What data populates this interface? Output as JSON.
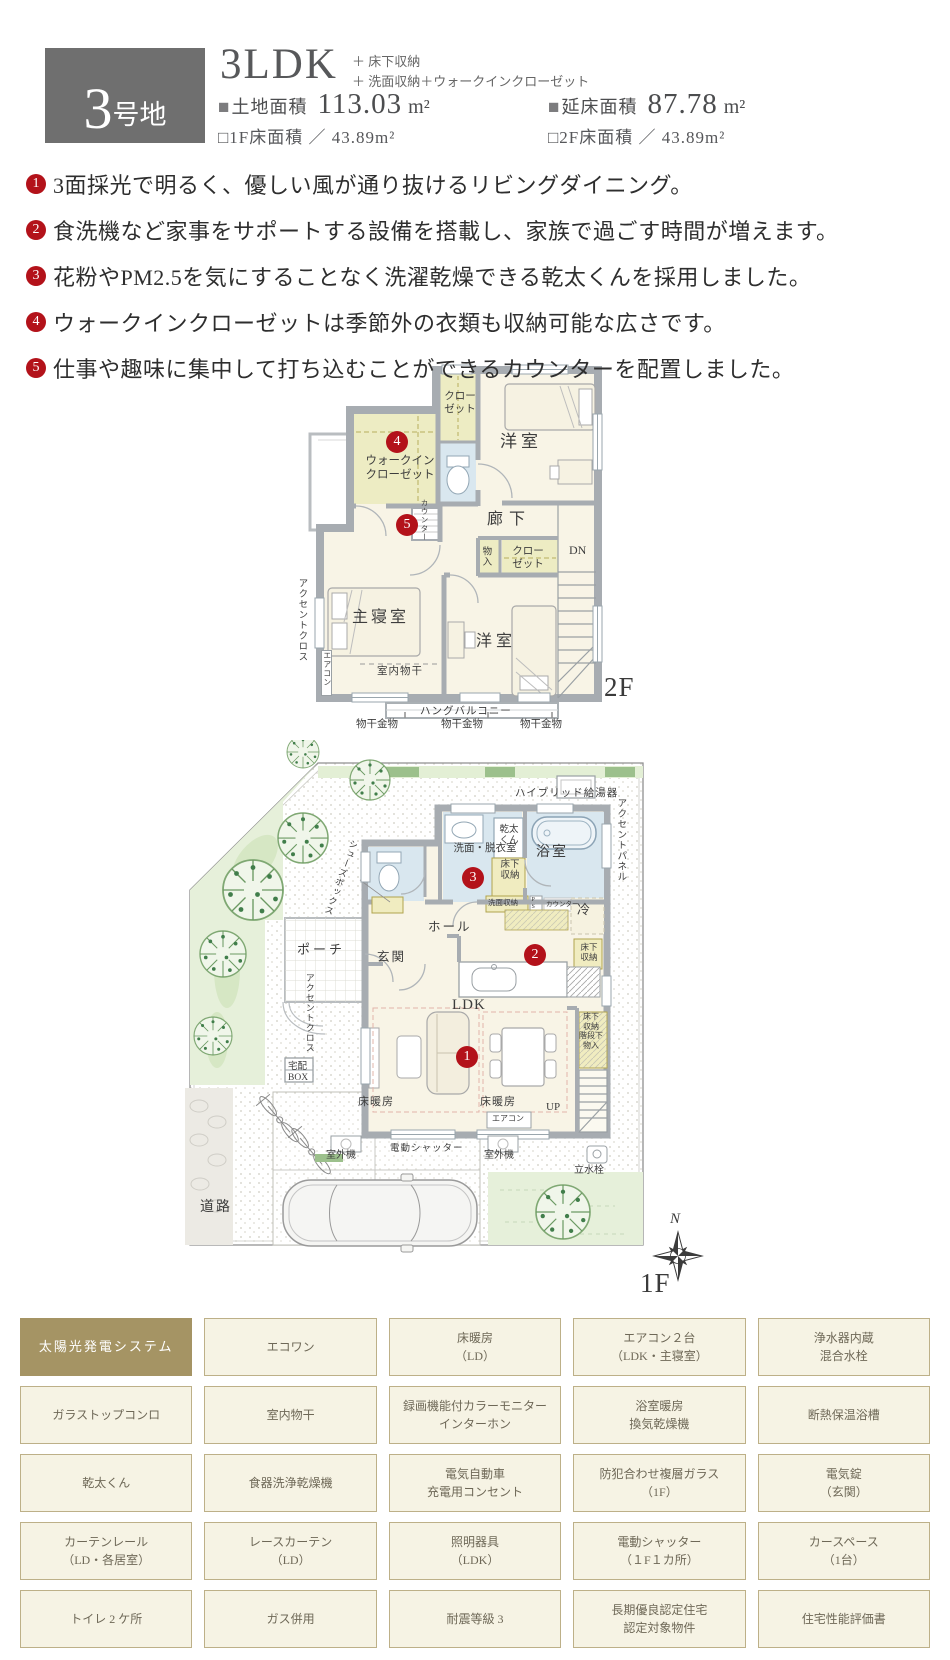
{
  "colors": {
    "accent_red": "#b3121a",
    "badge_gray": "#6f6f6f",
    "grid_highlight_bg": "#a59464",
    "grid_cell_bg": "#f6f3e4",
    "grid_border": "#bdb088",
    "room_cream": "#f8f4e6",
    "closet_yellow": "#edecc3",
    "wet_area_blue": "#d9e7ef",
    "garden_green": "#e6f0da",
    "wall_gray": "#a7acb1"
  },
  "header": {
    "lot_badge_num": "3",
    "lot_badge_suffix": "号地",
    "plan_type": "3LDK",
    "plan_extra": "＋ 床下収納\n＋ 洗面収納＋ウォークインクローゼット",
    "land_bullet": "■",
    "land_label": "土地面積",
    "land_value": "113.03",
    "land_unit": "m²",
    "total_bullet": "■",
    "total_label": "延床面積",
    "total_value": "87.78",
    "total_unit": "m²",
    "floor1_area": "□1F床面積 ／ 43.89m²",
    "floor2_area": "□2F床面積 ／ 43.89m²"
  },
  "notes": [
    {
      "num": "1",
      "text": "3面採光で明るく、優しい風が通り抜けるリビングダイニング。"
    },
    {
      "num": "2",
      "text": "食洗機など家事をサポートする設備を搭載し、家族で過ごす時間が増えます。"
    },
    {
      "num": "3",
      "text": "花粉やPM2.5を気にすることなく洗濯乾燥できる乾太くんを採用しました。"
    },
    {
      "num": "4",
      "text": "ウォークインクローゼットは季節外の衣類も収納可能な広さです。"
    },
    {
      "num": "5",
      "text": "仕事や趣味に集中して打ち込むことができるカウンターを配置しました。"
    }
  ],
  "plan2f": {
    "floor_tag": "2F",
    "markers": {
      "wic": "4",
      "counter": "5"
    },
    "labels": {
      "closet_top": "クロー\nゼット",
      "bedroom_top": "洋室",
      "wic": "ウォークイン\nクローゼット",
      "counter": "カウンター",
      "hallway": "廊下",
      "storage": "物入",
      "closet_mid": "クロー\nゼット",
      "down": "DN",
      "accent_cloth": "アクセントクロス",
      "aircon": "エアコン",
      "master_bedroom": "主寝室",
      "indoor_drying": "室内物干",
      "bedroom_bottom": "洋室",
      "hang_balcony": "ハングバルコニー",
      "drying_hardware": "物干金物"
    }
  },
  "plan1f": {
    "floor_tag": "1F",
    "north": "N",
    "markers": {
      "living": "1",
      "kitchen": "2",
      "laundry": "3"
    },
    "labels": {
      "road": "道路",
      "hybrid_heater": "ハイブリッド給湯器",
      "accent_panel": "アクセントパネル",
      "shoes_box": "シューズボックス",
      "kanta_kun": "乾太\nくん",
      "washroom": "洗面・脱衣室",
      "floor_storage1": "床下\n収納",
      "bathroom": "浴室",
      "wash_storage": "洗面収納",
      "ps": "PS",
      "counter": "カウンター",
      "fridge": "冷",
      "floor_storage2": "床下\n収納",
      "porch": "ポーチ",
      "entrance": "玄関",
      "hall": "ホール",
      "accent_cloth": "アクセントクロス",
      "delivery_box": "宅配\nBOX",
      "ldk": "LDK",
      "under_stairs": "床下\n収納\n階段下\n物入",
      "floor_heating": "床暖房",
      "aircon": "エアコン",
      "up": "UP",
      "shutter": "電動シャッター",
      "outdoor_unit": "室外機",
      "faucet": "立水栓"
    }
  },
  "equipment_grid": {
    "rows": [
      [
        "太陽光発電システム",
        "エコワン",
        "床暖房\n（LD）",
        "エアコン２台\n（LDK・主寝室）",
        "浄水器内蔵\n混合水栓"
      ],
      [
        "ガラストップコンロ",
        "室内物干",
        "録画機能付カラーモニター\nインターホン",
        "浴室暖房\n換気乾燥機",
        "断熱保温浴槽"
      ],
      [
        "乾太くん",
        "食器洗浄乾燥機",
        "電気自動車\n充電用コンセント",
        "防犯合わせ複層ガラス\n（1F）",
        "電気錠\n（玄関）"
      ],
      [
        "カーテンレール\n（LD・各居室）",
        "レースカーテン\n（LD）",
        "照明器具\n（LDK）",
        "電動シャッター\n（１F１カ所）",
        "カースペース\n（1台）"
      ],
      [
        "トイレ 2 ケ所",
        "ガス併用",
        "耐震等級 3",
        "長期優良認定住宅\n認定対象物件",
        "住宅性能評価書"
      ]
    ]
  }
}
